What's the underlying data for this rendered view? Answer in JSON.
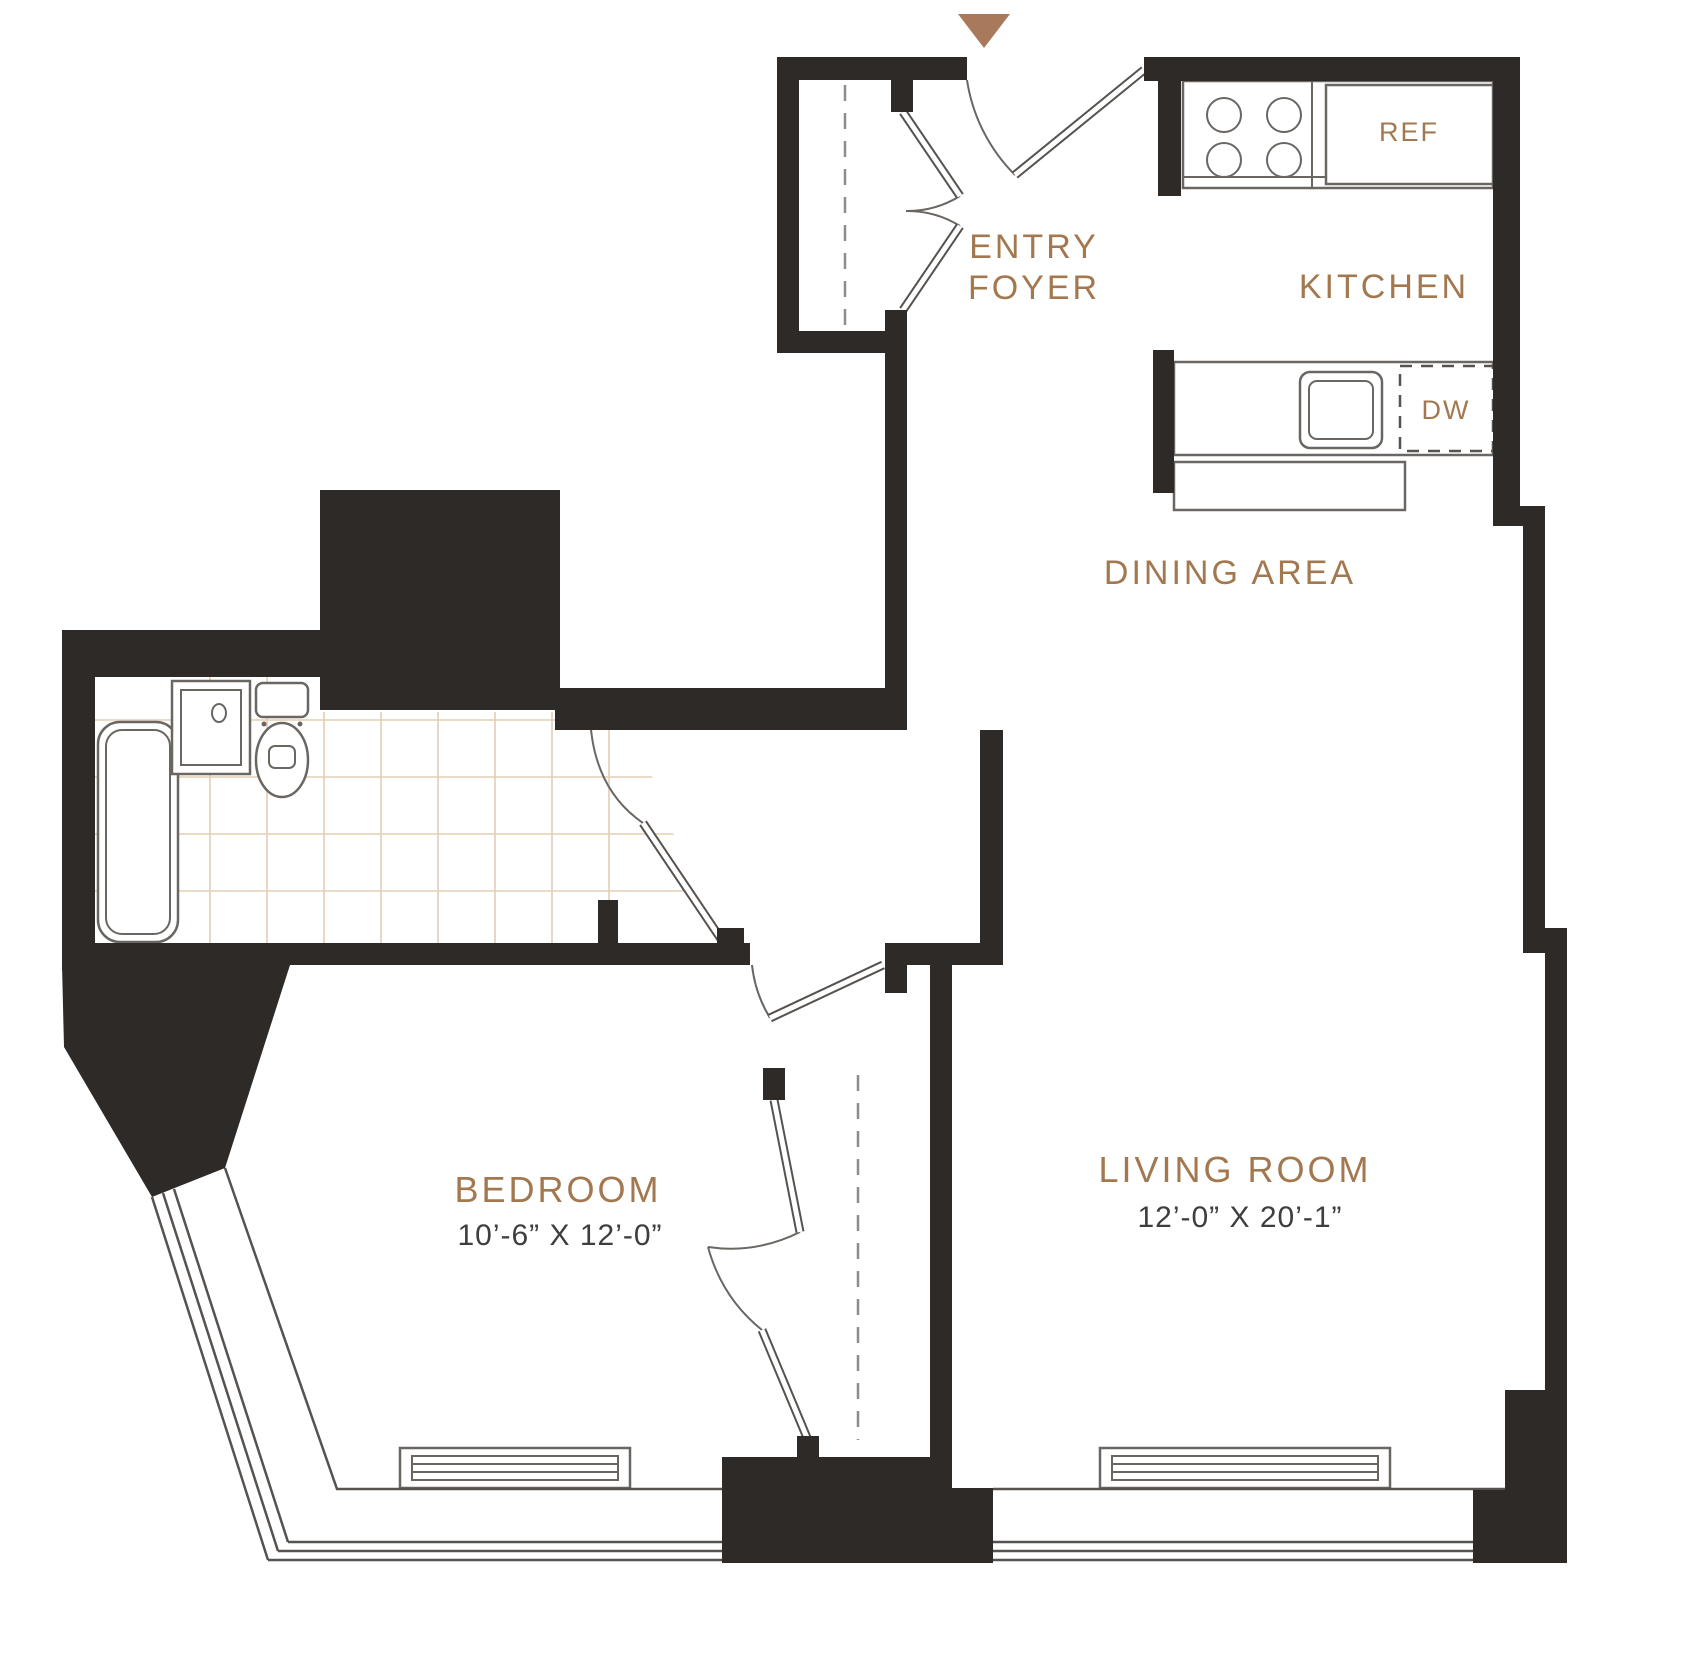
{
  "labels": {
    "entry_foyer_line1": "ENTRY",
    "entry_foyer_line2": "FOYER",
    "kitchen": "KITCHEN",
    "ref": "REF",
    "dw": "DW",
    "dining": "DINING AREA",
    "bedroom": "BEDROOM",
    "bedroom_dims": "10’-6” X 12’-0”",
    "living": "LIVING ROOM",
    "living_dims": "12’-0” X 20’-1”"
  },
  "colors": {
    "wall": "#2d2a27",
    "room_label": "#a3784f",
    "dimension_text": "#3e3e3e",
    "tile_grid": "#e4cdb4",
    "fixture_line": "#6a6662",
    "entry_marker": "#a8795a"
  }
}
